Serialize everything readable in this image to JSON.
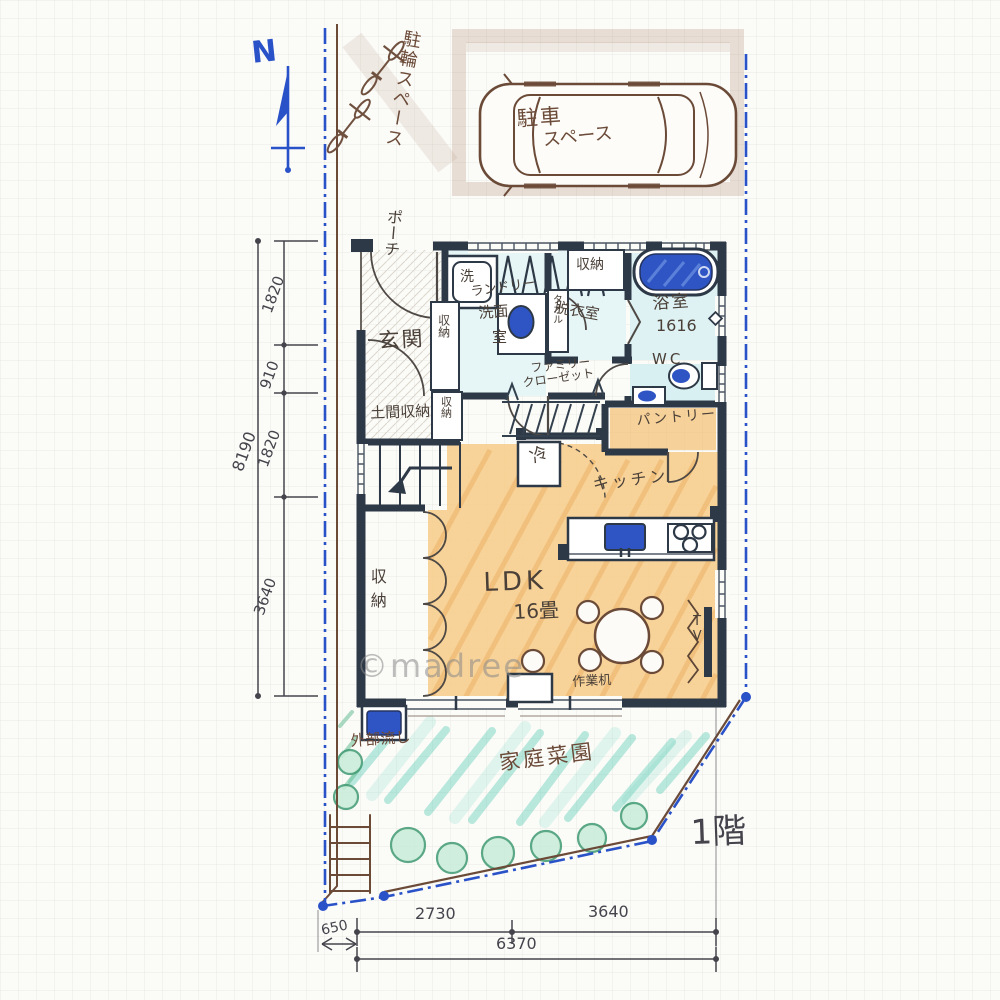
{
  "palette": {
    "wall": "#2e3947",
    "wet_room": "#e4f4f5",
    "floor_orange": "#f6c87e",
    "garden_teal": "#5fcfba",
    "fixture_blue": "#2f55c4",
    "boundary_blue": "#2a52c8",
    "sketch_brown": "#6b4a38",
    "dimension_gray": "#45444c"
  },
  "compass": {
    "north": "N"
  },
  "site": {
    "bicycle_parking": "駐輪スペース",
    "car_parking_line1": "駐車",
    "car_parking_line2": "スペース",
    "garden": "家庭菜園",
    "outdoor_sink": "外部流し",
    "floor": "1階"
  },
  "rooms": {
    "porch": "ポーチ",
    "entrance": "玄関",
    "doma_storage": "土間収納",
    "storage_a": "収納",
    "storage_b": "収納",
    "washer": "洗",
    "laundry_l1": "ランドリー",
    "laundry_l2": "洗面",
    "laundry_l3": "室",
    "towel": "タオル",
    "dressing": "脱衣室",
    "dressing_storage": "収納",
    "bath_l1": "浴室",
    "bath_l2": "1616",
    "wc": "WC",
    "family_closet_l1": "ファミリー",
    "family_closet_l2": "クローゼット",
    "pantry": "パントリー",
    "fridge": "冷",
    "kitchen": "キッチン",
    "ldk_l1": "LDK",
    "ldk_l2": "16畳",
    "ldk_storage": "収納",
    "desk": "作業机",
    "tv": "TV"
  },
  "dimensions": {
    "left_total": "8190",
    "left_seg_1": "1820",
    "left_seg_2": "910",
    "left_seg_3": "1820",
    "left_seg_4": "3640",
    "bottom_seg_1": "2730",
    "bottom_seg_2": "3640",
    "bottom_total": "6370",
    "bottom_offset": "650"
  },
  "watermark": "©madree"
}
